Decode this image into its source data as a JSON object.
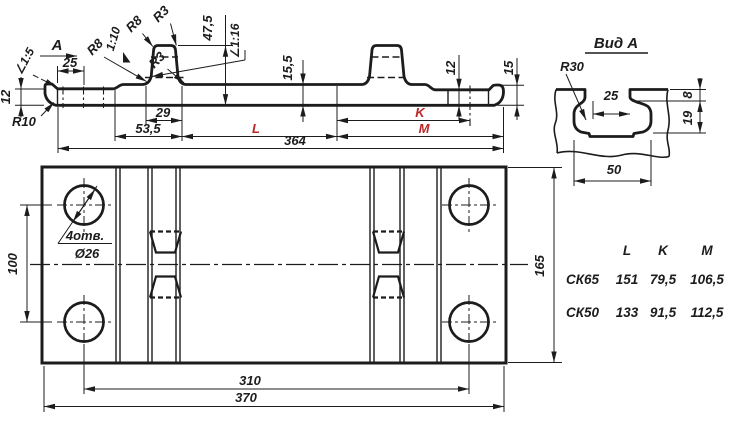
{
  "colors": {
    "line": "#1c1c1c",
    "red": "#bb2525",
    "background": "#ffffff"
  },
  "profile": {
    "view_arrow_label": "A",
    "slope_left": "∠1:5",
    "dim_25": "25",
    "dim_12_left": "12",
    "r10": "R10",
    "r8_lower": "R8",
    "slope_rib": "1:10",
    "r8_upper": "R8",
    "r3_top": "R3",
    "r3_base": "R3",
    "dim_47_5": "47,5",
    "slope_seat": "∠1:16",
    "dim_15_5": "15,5",
    "dim_29": "29",
    "dim_53_5": "53,5",
    "dim_L": "L",
    "dim_K": "K",
    "dim_M": "M",
    "dim_364": "364",
    "dim_12_right": "12",
    "dim_15_right": "15"
  },
  "plan": {
    "holes_count": "4отв.",
    "holes_dia": "Ø26",
    "dim_100": "100",
    "dim_165": "165",
    "dim_310": "310",
    "dim_370": "370"
  },
  "view_a": {
    "title": "Вид А",
    "r30": "R30",
    "dim_25": "25",
    "dim_8": "8",
    "dim_19": "19",
    "dim_50": "50"
  },
  "table": {
    "headers": {
      "l": "L",
      "k": "K",
      "m": "M"
    },
    "rows": [
      {
        "name": "СК65",
        "l": "151",
        "k": "79,5",
        "m": "106,5"
      },
      {
        "name": "СК50",
        "l": "133",
        "k": "91,5",
        "m": "112,5"
      }
    ]
  }
}
